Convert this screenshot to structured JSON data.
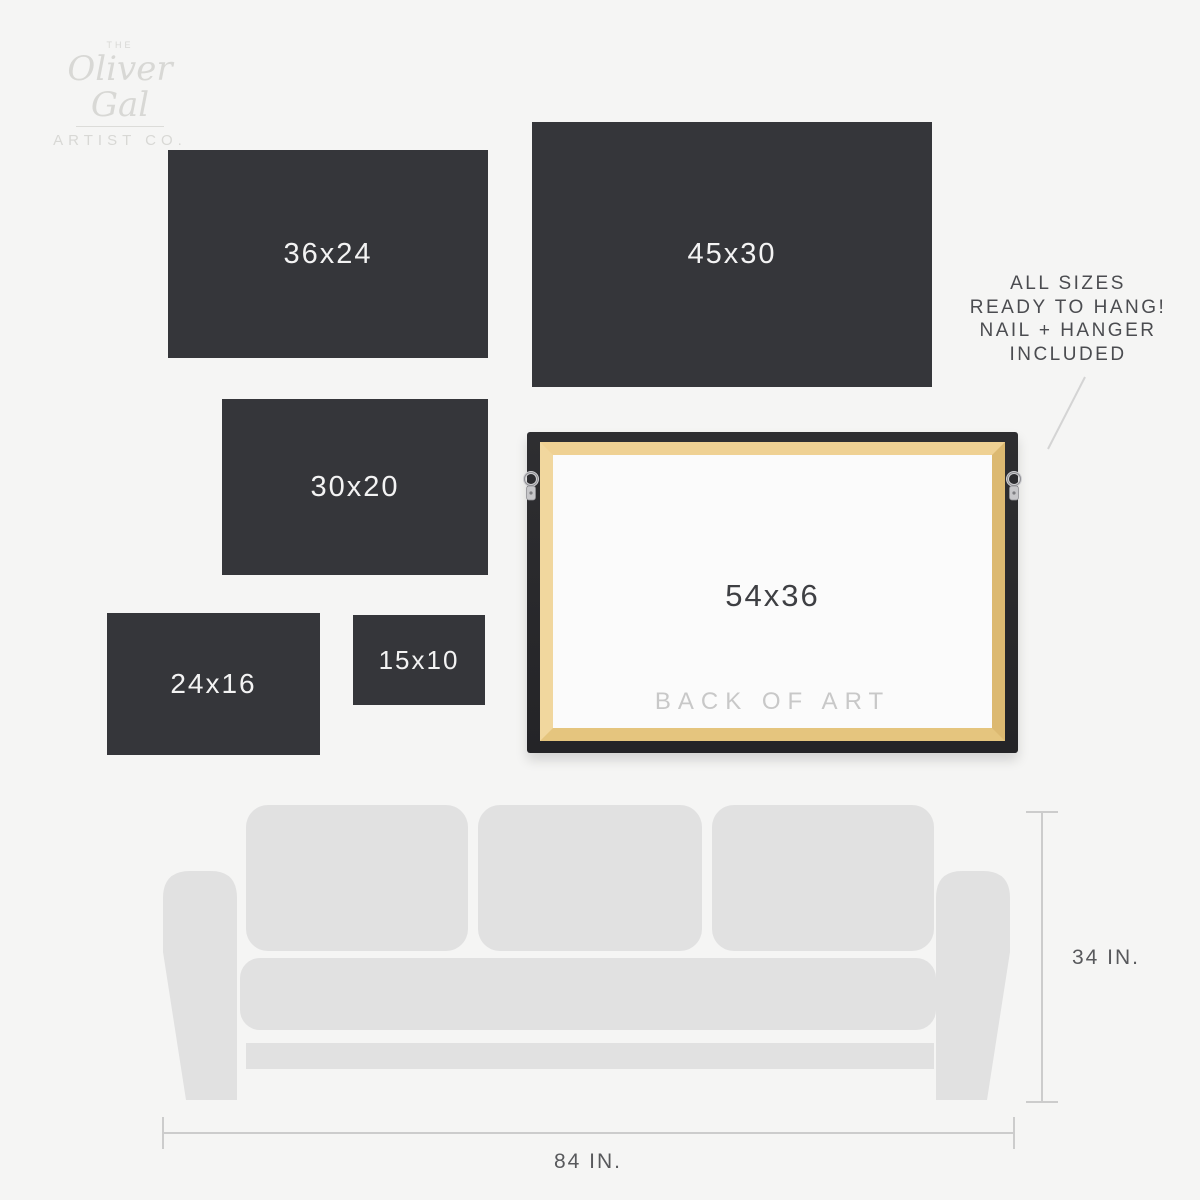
{
  "brand": {
    "the": "THE",
    "name": "Oliver Gal",
    "subtitle": "ARTIST CO."
  },
  "sizes": [
    {
      "label": "36x24"
    },
    {
      "label": "45x30"
    },
    {
      "label": "30x20"
    },
    {
      "label": "24x16"
    },
    {
      "label": "15x10"
    }
  ],
  "frame": {
    "size_label": "54x36",
    "back_label": "BACK OF ART"
  },
  "info_note": {
    "lines": [
      "ALL SIZES",
      "READY TO HANG!",
      "NAIL + HANGER",
      "INCLUDED"
    ]
  },
  "dimensions": {
    "sofa_height": "34 IN.",
    "sofa_width": "84 IN."
  },
  "colors": {
    "background": "#f5f5f4",
    "size_box": "#35363a",
    "size_box_text": "#f3f3f3",
    "sofa": "#e1e1e1",
    "dimension_line": "#cccccc",
    "frame_black": "#29292c",
    "frame_wood": "#e8c982",
    "canvas_back": "#fbfbfb",
    "note_text": "#4b4c50",
    "muted_label": "#c8c8c8",
    "logo_gray": "#d8d8d5"
  }
}
